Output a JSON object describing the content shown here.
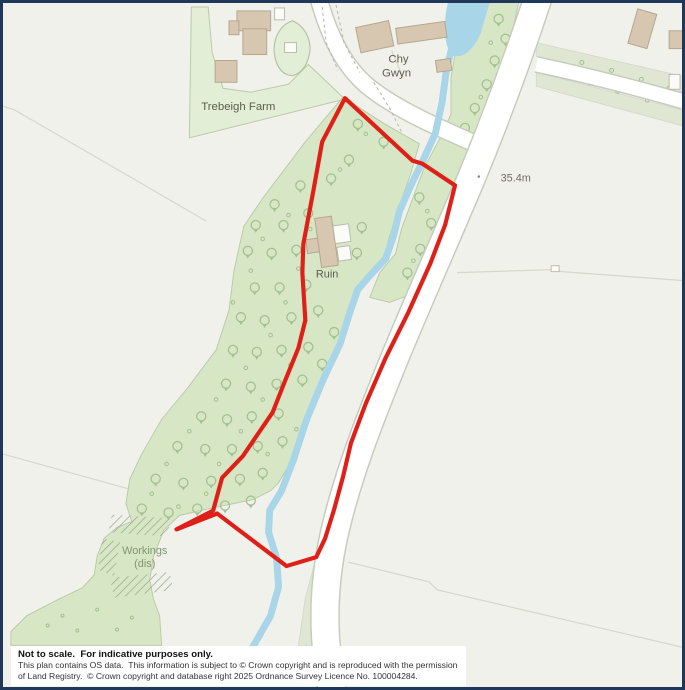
{
  "map": {
    "labels": {
      "farm": "Trebeigh Farm",
      "house_line1": "Chy",
      "house_line2": "Gwyn",
      "ruin": "Ruin",
      "spot_height": "35.4m",
      "workings_line1": "Workings",
      "workings_line2": "(dis)"
    }
  },
  "disclaimer": {
    "line1": "Not to scale.  For indicative purposes only.",
    "line2": "This plan contains OS data.  This information is subject to © Crown copyright and is reproduced with the permission",
    "line3": "of Land Registry.  © Crown copyright and database right 2025 Ordnance Survey Licence No. 100004284."
  },
  "colors": {
    "boundary-red": "#de2019",
    "water-blue": "#a8d6e8",
    "wood-green": "#d7e7c6",
    "wood-edge": "#bccaa8",
    "field-green": "#e3eed6",
    "verge-green": "#dfe6d1",
    "building-tan": "#d8c7b0",
    "building-outline": "#b4a78f",
    "road-white": "#ffffff",
    "road-casing": "#c6ccbd",
    "bg": "#f1f1eb",
    "frame-navy": "#20375c",
    "label-gray": "#5c5c50",
    "label-green": "#7f9670",
    "height-gray": "#6e6e66",
    "tree-green": "#a3c090",
    "hatch-green": "#96a584",
    "field-line": "#d6d6cc"
  }
}
